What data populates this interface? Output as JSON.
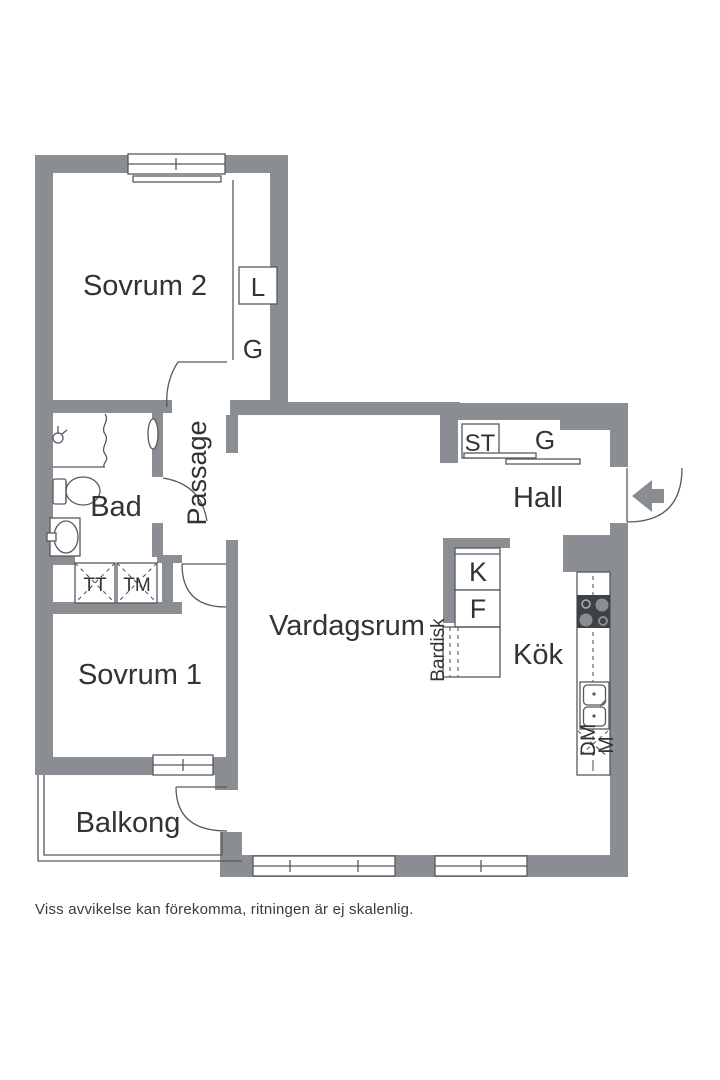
{
  "floor_plan": {
    "rooms": {
      "sovrum2": "Sovrum 2",
      "bad": "Bad",
      "passage": "Passage",
      "sovrum1": "Sovrum 1",
      "balkong": "Balkong",
      "vardagsrum": "Vardagsrum",
      "hall": "Hall",
      "kok": "Kök"
    },
    "closets": {
      "linen_label": "L",
      "wardrobe_sovrum2_label": "G",
      "cleaning_label": "ST",
      "wardrobe_hall_label": "G"
    },
    "laundry": {
      "dryer_label": "TT",
      "washer_label": "TM"
    },
    "kitchen": {
      "fridge_label": "K",
      "freezer_label": "F",
      "dishwasher_label": "DM",
      "micro_label": "M",
      "bar_counter_label": "Bardisk"
    },
    "disclaimer": "Viss avvikelse kan förekomma, ritningen är ej skalenlig.",
    "colors": {
      "wall": "#8a8e92",
      "line": "#555a5e",
      "text": "#333333",
      "stove": "#3f4245",
      "background": "#ffffff"
    }
  }
}
